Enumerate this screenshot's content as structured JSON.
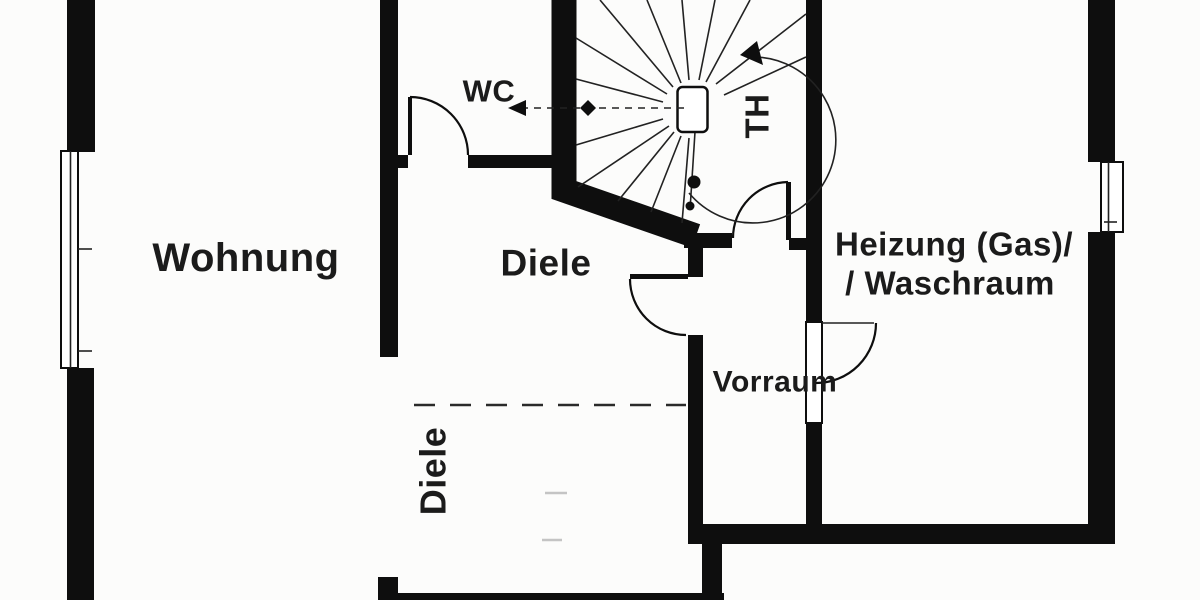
{
  "plan": {
    "type": "floor-plan",
    "colors": {
      "background": "#fcfcfb",
      "wall": "#0e0e0e",
      "text": "#1b1b1b",
      "line": "#222222",
      "faint_dash": "#c4c4c4"
    },
    "rooms": {
      "wohnung": {
        "label": "Wohnung"
      },
      "wc": {
        "label": "WC"
      },
      "diele_upper": {
        "label": "Diele"
      },
      "diele_lower": {
        "label": "Diele"
      },
      "th": {
        "label": "TH"
      },
      "vorraum": {
        "label": "Vorraum"
      },
      "heizung": {
        "label_line1": "Heizung (Gas)/",
        "label_line2": "/ Waschraum"
      }
    },
    "symbols": {
      "stair": "spiral-staircase",
      "stair_direction": "clockwise-up",
      "windows": 2,
      "doors": 4
    }
  }
}
